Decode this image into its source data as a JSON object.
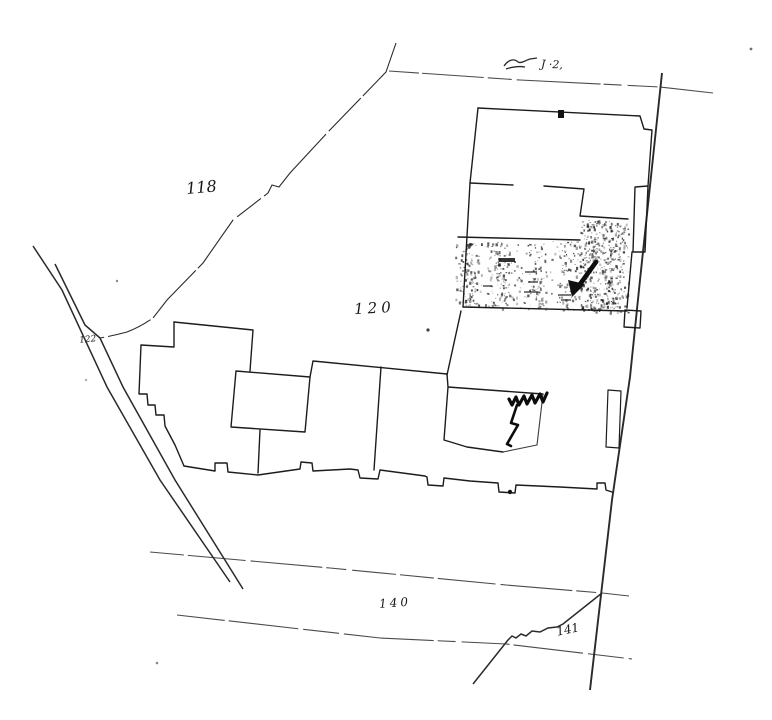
{
  "map": {
    "type": "hand-drawn parcel survey sketch (photocopy)",
    "paper_color": "#ffffff",
    "ink_color": "#1c1c1c",
    "parcel_labels": {
      "p118": "118",
      "p120": "120",
      "p122": "122",
      "p140": "140",
      "p141": "141"
    },
    "annotations": {
      "top_scrawl": "J ·2,",
      "arrow_mark": "bold arrow pointing down-left",
      "zigzag_mark": "bold zigzag scribble"
    }
  }
}
